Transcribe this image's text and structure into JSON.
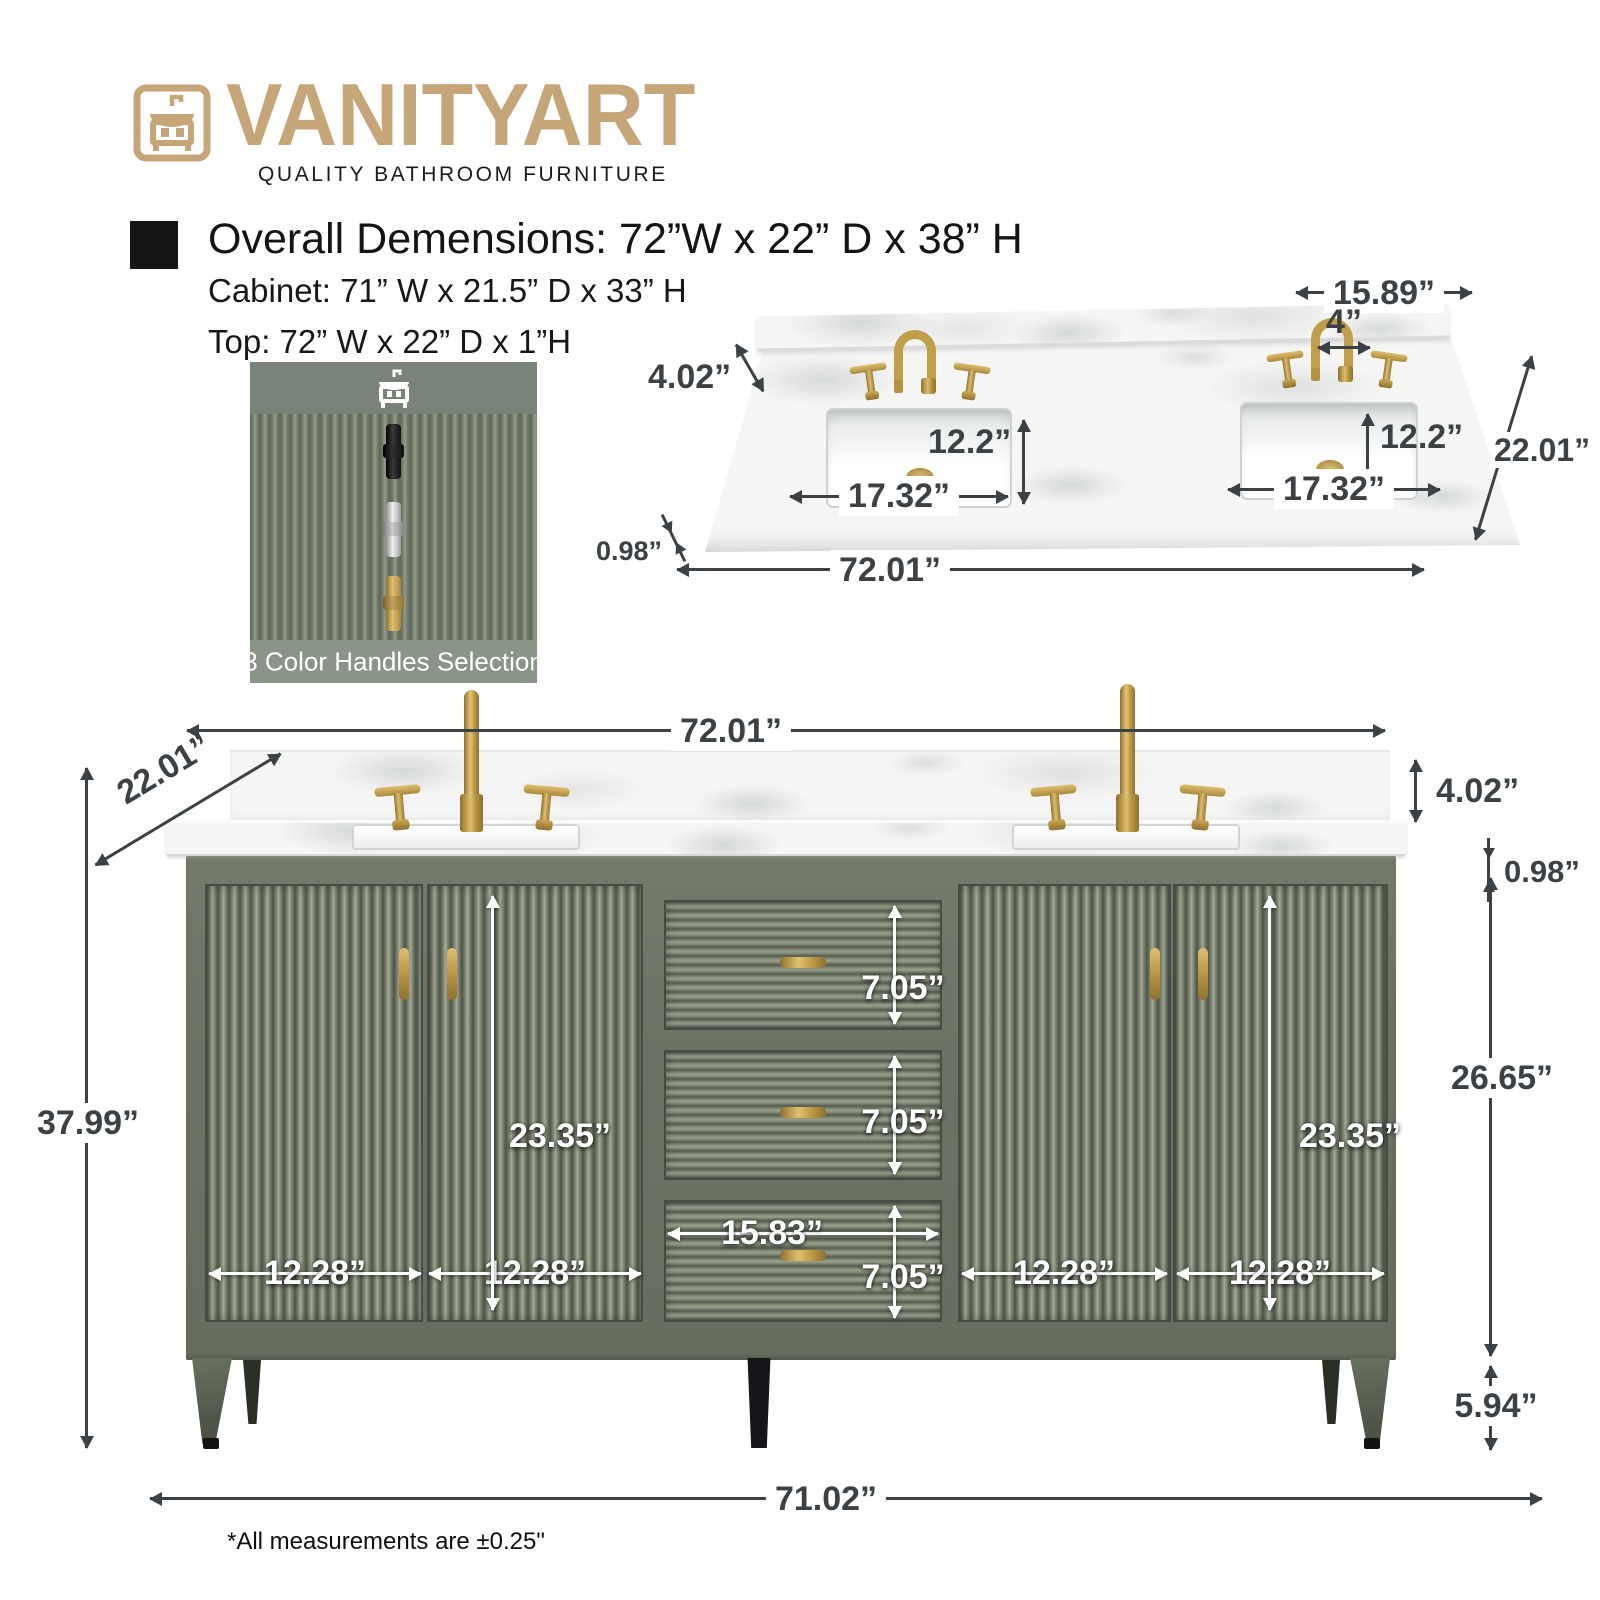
{
  "brand": {
    "name": "VANITYART",
    "tagline": "QUALITY BATHROOM FURNITURE"
  },
  "heading": {
    "overall": "Overall Demensions: 72”W x 22” D x 38” H",
    "cabinet": "Cabinet: 71” W x 21.5” D x 33” H",
    "top": "Top: 72” W x 22” D x 1”H"
  },
  "handles_panel": {
    "caption": "3 Color Handles Selection",
    "options": [
      "black",
      "chrome",
      "gold"
    ]
  },
  "top_view": {
    "sink_edge_offset": "15.89”",
    "faucet_spread": "4”",
    "backsplash_height": "4.02”",
    "sink_depth": "12.2”",
    "overall_depth": "22.01”",
    "sink_width": "17.32”",
    "top_thickness": "0.98”",
    "overall_width": "72.01”"
  },
  "front_view": {
    "overall_width": "72.01”",
    "overall_depth": "22.01”",
    "backsplash_height": "4.02”",
    "top_thickness": "0.98”",
    "overall_height": "37.99”",
    "door_height": "23.35”",
    "cabinet_height": "26.65”",
    "drawer_height": "7.05”",
    "drawer_width": "15.83”",
    "door_width": "12.28”",
    "leg_height": "5.94”",
    "base_width": "71.02”"
  },
  "footnote": "*All measurements are ±0.25\"",
  "colors": {
    "brand_gold": "#c6a679",
    "cabinet_green": "#6d7465",
    "hardware_gold": "#c09e4a",
    "marble_white": "#f5f5f3",
    "dimension_text": "#3b4144",
    "black_handle": "#1d1d1d",
    "chrome_handle": "#c9c9c9"
  }
}
